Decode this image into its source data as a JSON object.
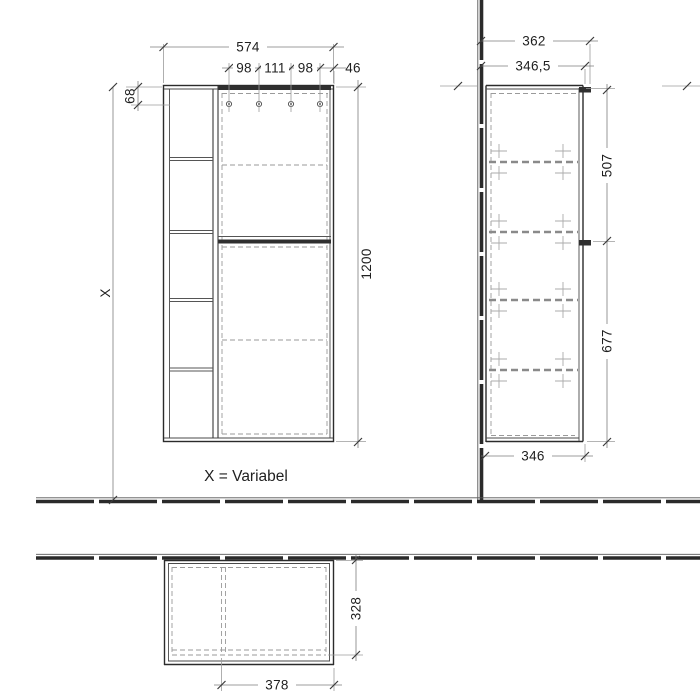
{
  "colors": {
    "line": "#2b2b2b",
    "dimension_line": "#7d7d7d",
    "extension_line": "#9b9b9b",
    "hidden_dash": "#9a9a9a",
    "handle_fill": "#2f2f2f",
    "background": "#ffffff"
  },
  "views": {
    "front": {
      "note": "X = Variabel",
      "dims": {
        "width_total": "574",
        "hole_spacing_left": "98",
        "hole_spacing_center": "111",
        "hole_spacing_right": "98",
        "hole_to_edge": "46",
        "top_to_holes": "68",
        "height_to_floor": "X",
        "height_total": "1200"
      }
    },
    "side": {
      "dims": {
        "depth_total": "362",
        "depth_body": "346,5",
        "upper_section_height": "507",
        "lower_section_height": "677",
        "depth_bottom": "346"
      }
    },
    "plan": {
      "dims": {
        "depth": "328",
        "door_width": "378"
      }
    }
  }
}
